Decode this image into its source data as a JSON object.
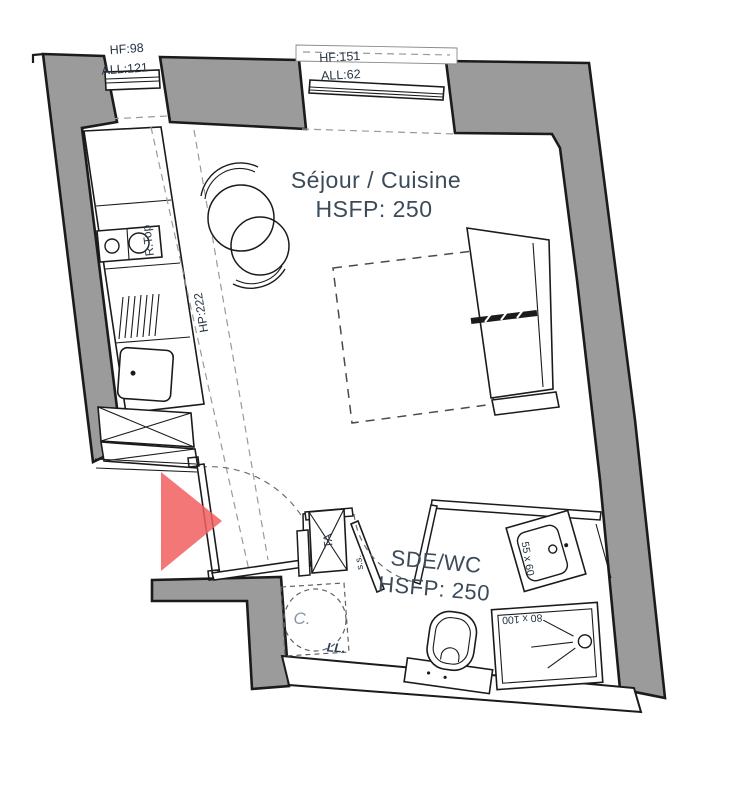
{
  "floor_plan": {
    "rooms": [
      {
        "name": "Séjour / Cuisine",
        "ceiling": "HSFP: 250"
      },
      {
        "name": "SDE/WC",
        "ceiling": "HSFP: 250"
      }
    ],
    "windows": [
      {
        "height_label": "HF:98",
        "sill_label": "ALL:121"
      },
      {
        "height_label": "HF:151",
        "sill_label": "ALL:62"
      }
    ],
    "annotations": {
      "slope_height": "HP:222",
      "cooktop": "R.Top",
      "electrical_panel": "TA",
      "towel_dryer": "s.s.",
      "water_heater": "C.",
      "washing_machine": "LL.",
      "sink_dimensions": "55 x 60",
      "shower_dimensions": "80 x 100"
    },
    "colors": {
      "wall_fill": "#9b9b9b",
      "line": "#1b1b1b",
      "entrance_arrow": "#f25f5f",
      "label_text": "#3c4b59",
      "dim_text": "#263544",
      "water_heater_text": "#8795a6",
      "dashed_guide": "#9a9a9a"
    }
  }
}
